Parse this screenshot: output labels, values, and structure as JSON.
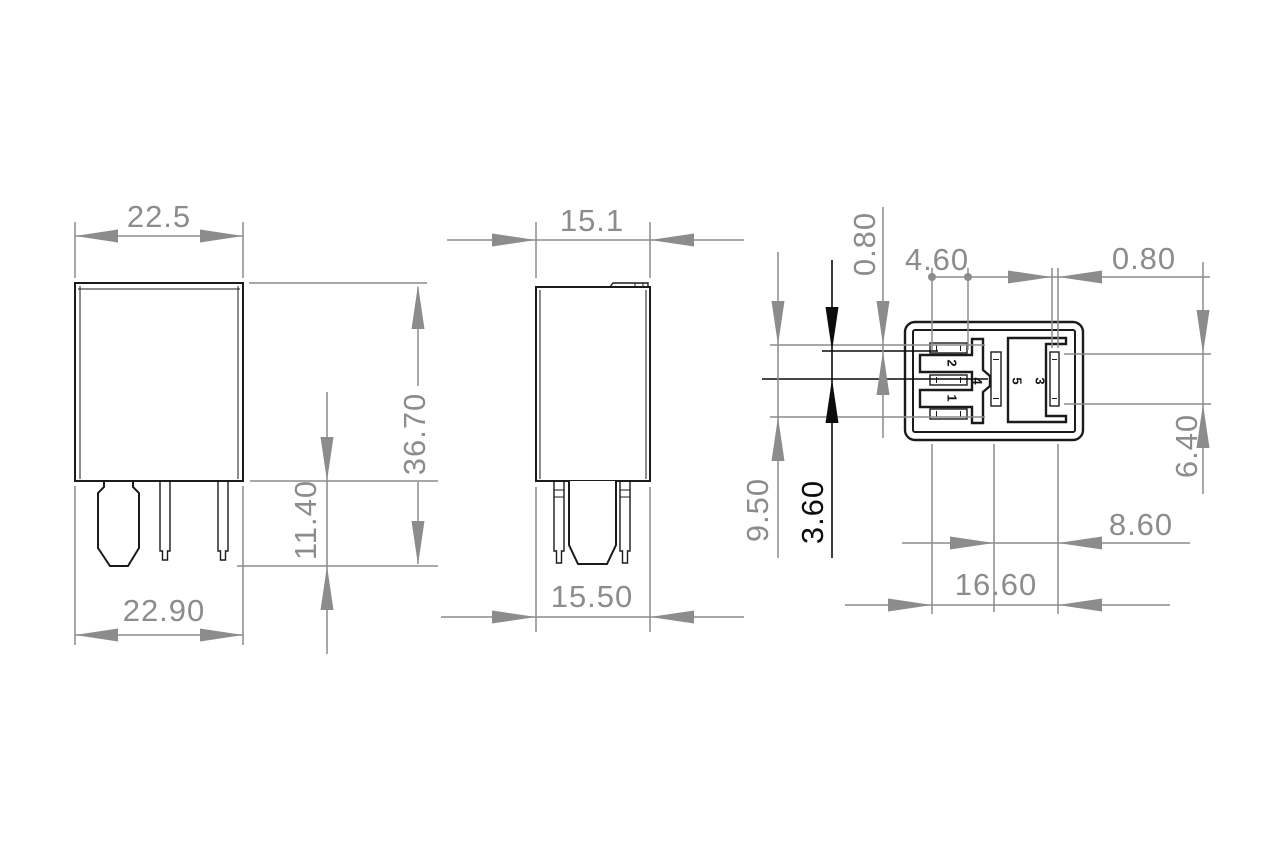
{
  "drawing": {
    "colors": {
      "outline": "#1b1b1b",
      "dimension": "#8a8c8e",
      "highlight_dimension": "#0c0c0c",
      "background": "#ffffff"
    },
    "front_view": {
      "width_top": "22.5",
      "height_overall": "36.70",
      "pin_length": "11.40",
      "width_bottom": "22.90"
    },
    "side_view": {
      "width_top": "15.1",
      "width_bottom": "15.50"
    },
    "bottom_view": {
      "slot_height": "0.80",
      "slot_length": "4.60",
      "slot_width": "0.80",
      "rows_span": "9.50",
      "row_pitch": "3.60",
      "blade_slot_height": "6.40",
      "center_to_blade": "8.60",
      "overall_span": "16.60",
      "pins": {
        "p1": "1",
        "p2": "2",
        "p3": "3",
        "p4": "4",
        "p5": "5"
      }
    }
  }
}
